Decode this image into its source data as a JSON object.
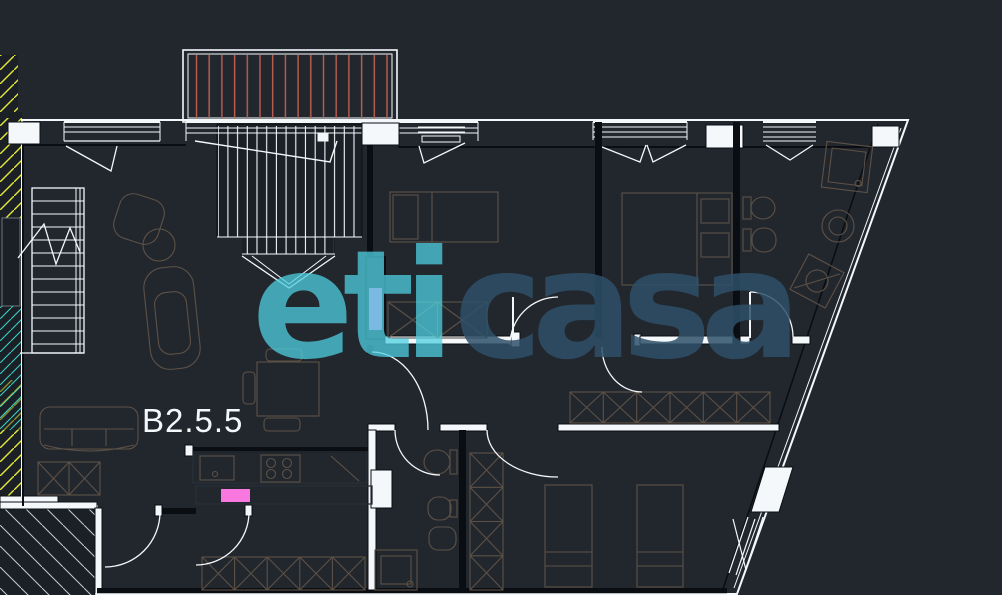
{
  "app": {
    "name": "floor-plan-viewer"
  },
  "unit": {
    "label": "B2.5.5"
  },
  "watermark": {
    "part1": "eti",
    "part2": "casa"
  },
  "colors": {
    "background": "#22272e",
    "dark_block": "#1b2026",
    "floor": "#55819b",
    "wall": "#0a0e13",
    "white_line": "#f4f8fb",
    "furniture_line": "#5d5146",
    "counter_line": "#2a3036",
    "watermark_eti": "#4fd0e0",
    "watermark_casa": "#2e5068",
    "accent_pink": "#f978e0",
    "hatch_yellow": "#e3e73a",
    "hatch_cyan": "#39cfc4",
    "terrace_hatch": "#bf5f4e",
    "hatch_light": "#c3ccd4"
  }
}
